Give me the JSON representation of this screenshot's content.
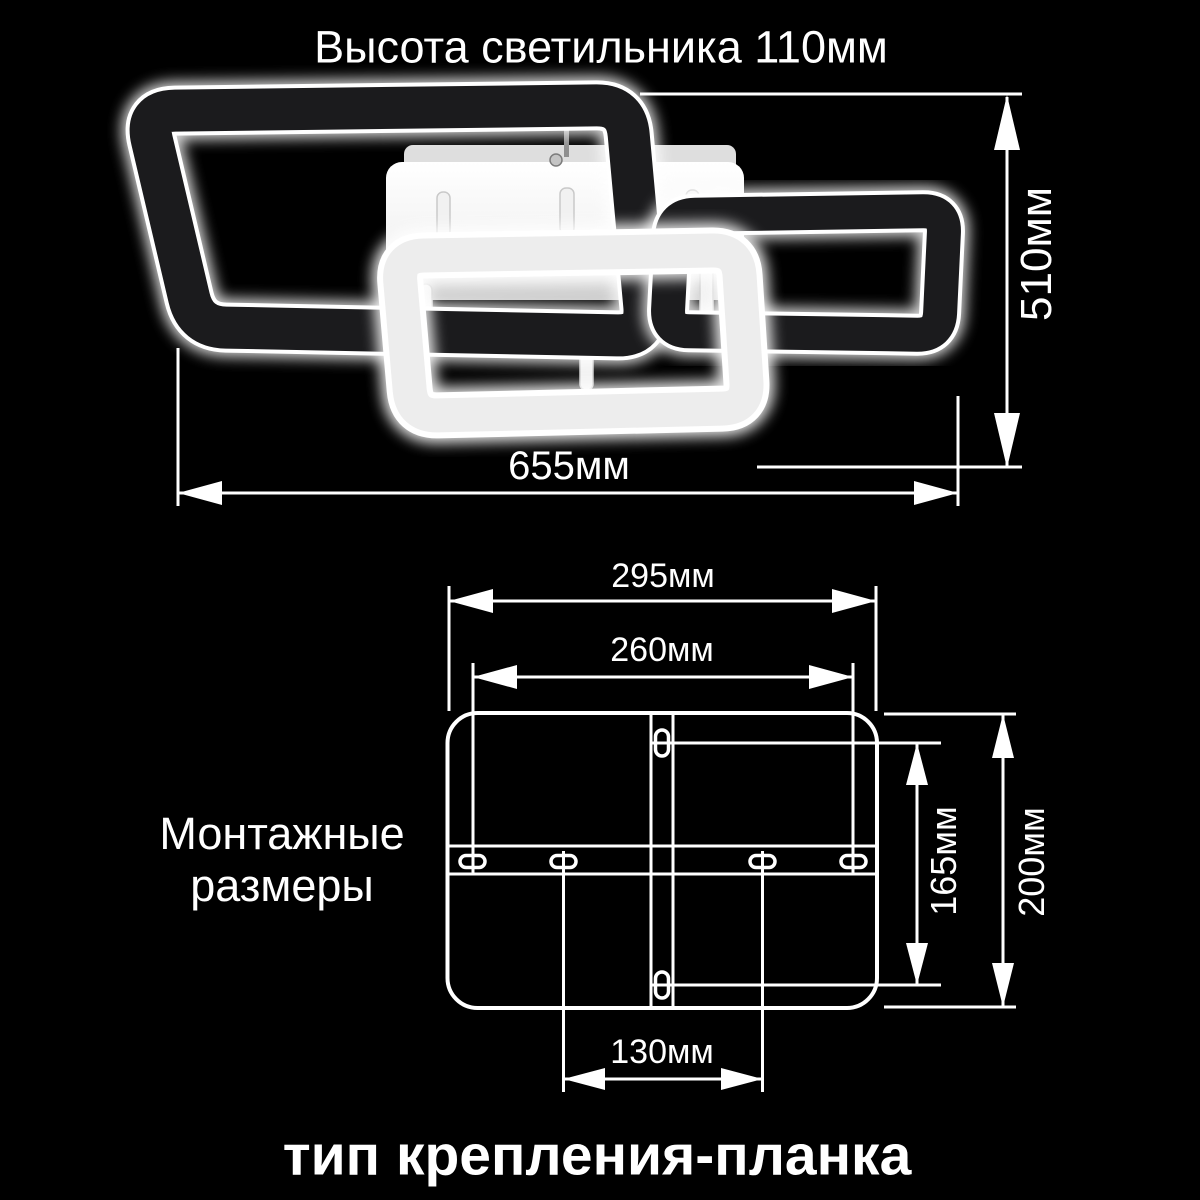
{
  "colors": {
    "background": "#000000",
    "line": "#ffffff",
    "frame_dark": "#1b1b1d",
    "frame_light": "#ededed",
    "canopy": "#f2f2f2"
  },
  "header": {
    "title": "Высота светильника 110мм"
  },
  "fixture": {
    "width_label": "655мм",
    "height_label": "510мм"
  },
  "mounting_diagram": {
    "section_label_line1": "Монтажные",
    "section_label_line2": "размеры",
    "outer_width_label": "295мм",
    "slot_span_label": "260мм",
    "slot_height_label": "165мм",
    "outer_height_label": "200мм",
    "center_slot_span_label": "130мм"
  },
  "footer": {
    "caption": "тип крепления-планка"
  }
}
